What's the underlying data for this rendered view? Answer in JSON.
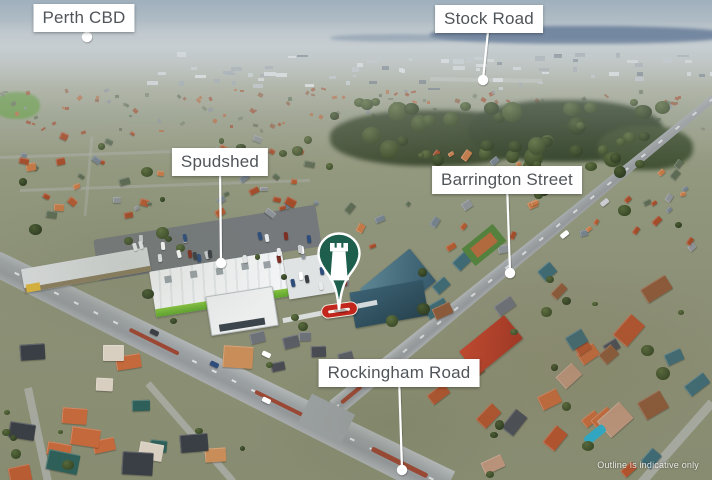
{
  "callouts": [
    {
      "id": "perth-cbd",
      "label": "Perth CBD"
    },
    {
      "id": "stock-road",
      "label": "Stock Road"
    },
    {
      "id": "spudshed",
      "label": "Spudshed"
    },
    {
      "id": "barrington-street",
      "label": "Barrington Street"
    },
    {
      "id": "rockingham-road",
      "label": "Rockingham Road"
    }
  ],
  "pin": {
    "icon": "rook-tower-icon"
  },
  "disclaimer": {
    "text": "Outline is indicative only"
  },
  "theme": {
    "label_bg": "#ffffff",
    "label_text": "#50555a",
    "leader": "#ffffff",
    "pin_fill": "#1e5e4c",
    "pin_glyph": "#ffffff"
  }
}
